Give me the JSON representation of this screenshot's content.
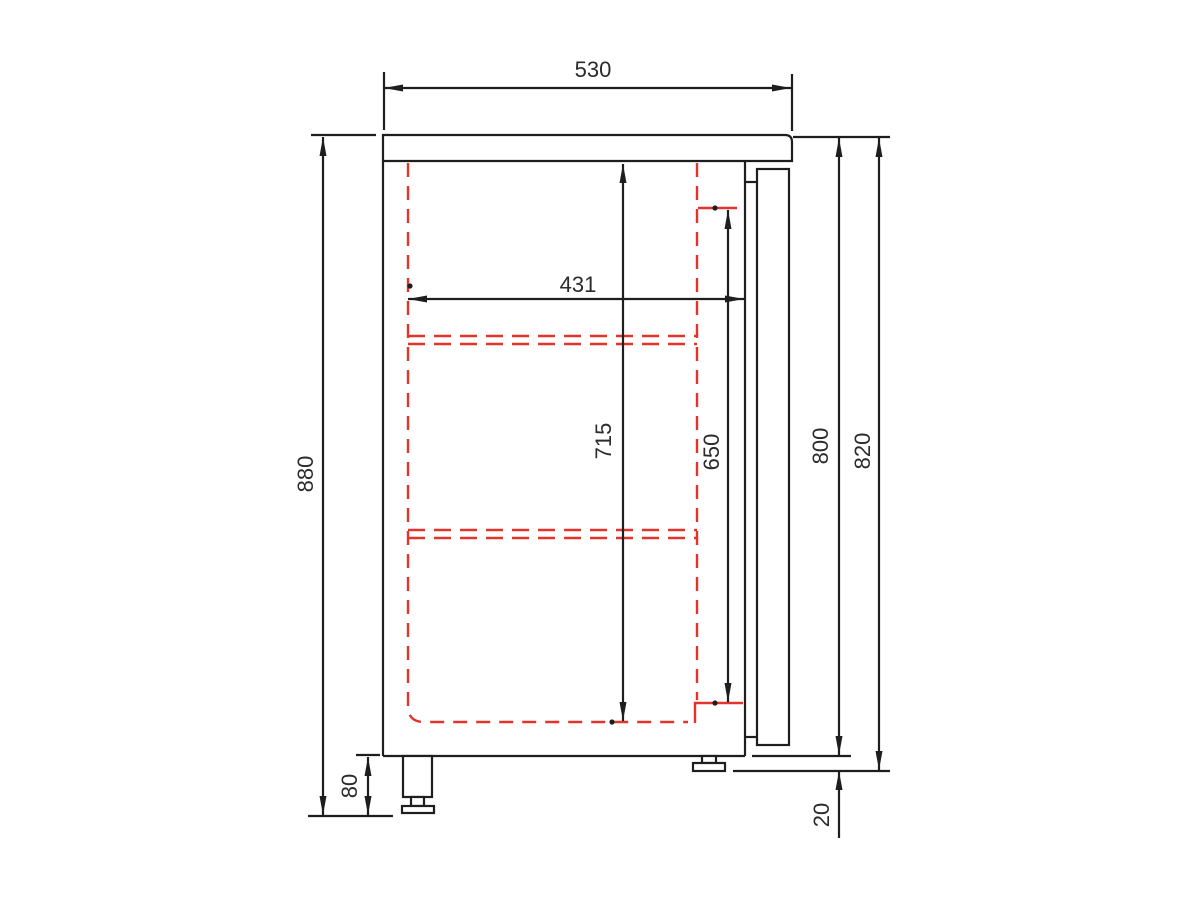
{
  "drawing": {
    "type": "technical-side-view",
    "colors": {
      "line": "#1e1e1e",
      "hidden_red": "#e2342a",
      "text": "#2b2b2b",
      "background": "#ffffff"
    },
    "dims": {
      "top_depth": "530",
      "inner_depth": "431",
      "overall_height": "880",
      "interior_height": "715",
      "door_opening_height": "650",
      "body_height": "800",
      "body_height_incl_foot": "820",
      "foot_height_max": "80",
      "foot_height_min": "20"
    }
  }
}
